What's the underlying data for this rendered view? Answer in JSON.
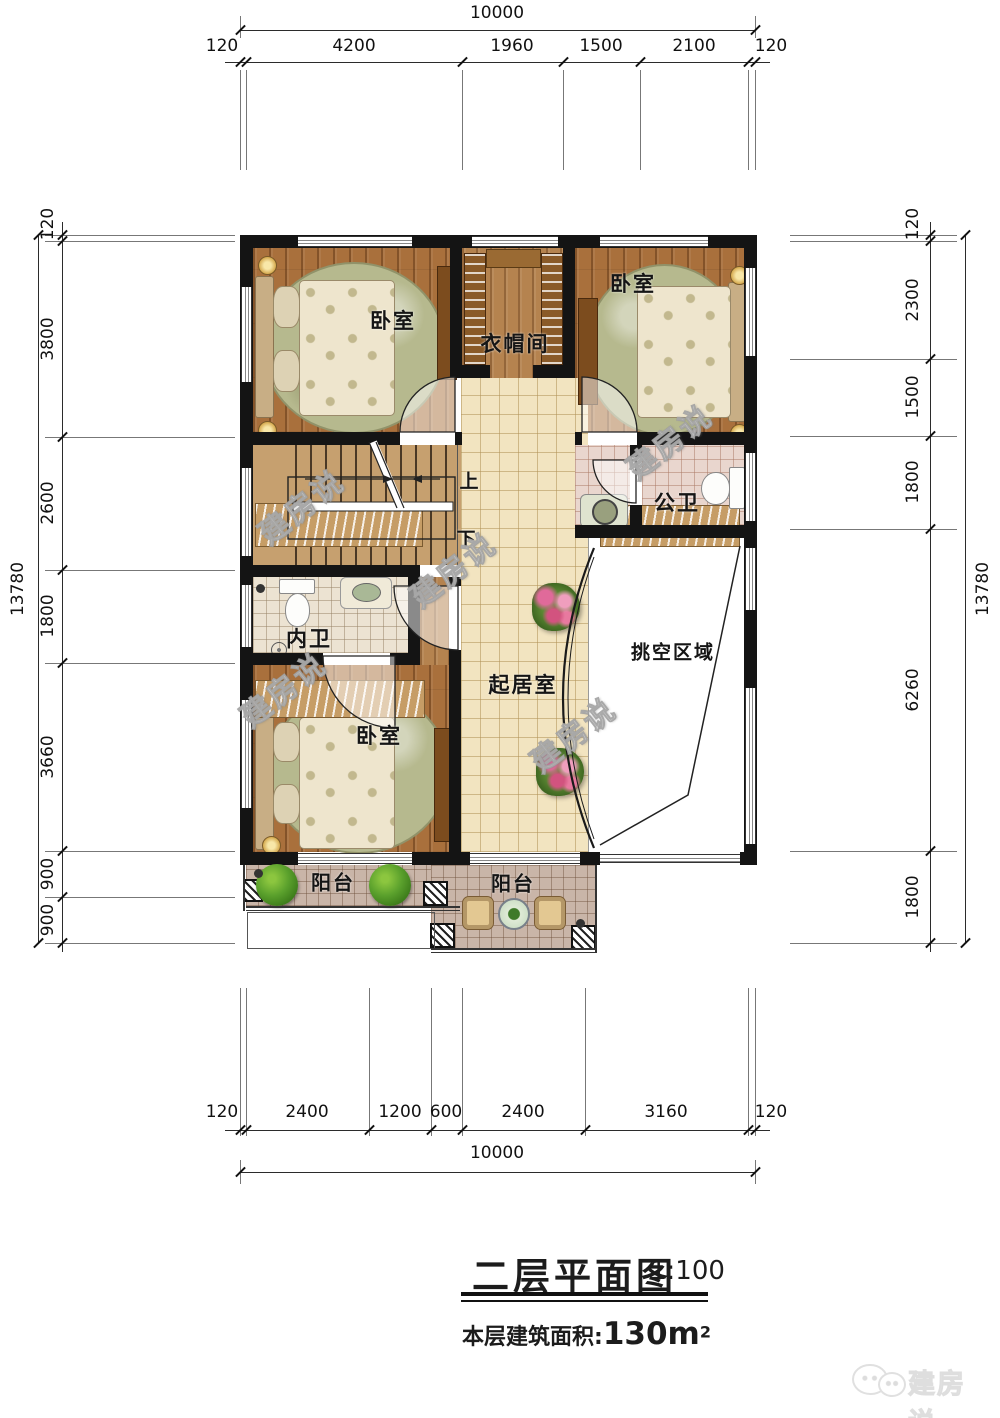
{
  "meta": {
    "title": "二层平面图",
    "scale": "1:100",
    "area_label": "本层建筑面积:",
    "area_value": "130m",
    "area_sup": "2"
  },
  "watermark": {
    "text": "建房说"
  },
  "logo": {
    "text": "建房说"
  },
  "dims": {
    "top": {
      "total": "10000",
      "segments": [
        "120",
        "4200",
        "1960",
        "1500",
        "2100",
        "120"
      ]
    },
    "bottom": {
      "total": "10000",
      "segments": [
        "120",
        "2400",
        "1200",
        "600",
        "2400",
        "3160",
        "120"
      ]
    },
    "left": {
      "total": "13780",
      "segments": [
        "120",
        "3800",
        "2600",
        "1800",
        "3660",
        "900",
        "900"
      ]
    },
    "right": {
      "total": "13780",
      "segments": [
        "120",
        "2300",
        "1500",
        "1800",
        "6260",
        "1800"
      ]
    }
  },
  "rooms": {
    "bedroom1": "卧室",
    "bedroom2": "卧室",
    "bedroom3": "卧室",
    "cloakroom": "衣帽间",
    "public_bath": "公卫",
    "private_bath": "内卫",
    "living": "起居室",
    "void_area": "挑空区域",
    "balcony_left": "阳台",
    "balcony_center": "阳台",
    "stairs_up": "上",
    "stairs_down": "下"
  }
}
